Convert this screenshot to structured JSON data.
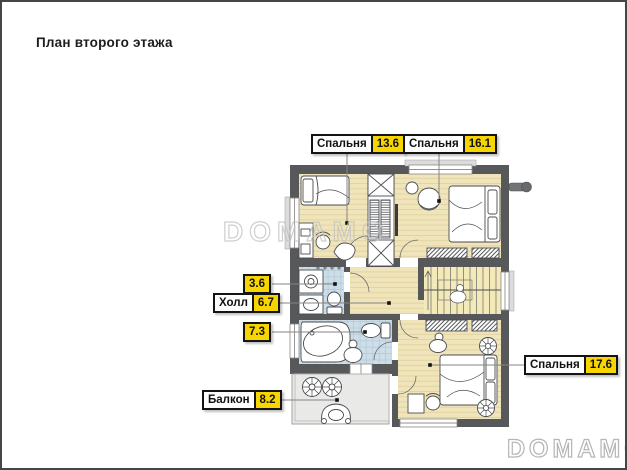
{
  "page": {
    "title": "План второго этажа"
  },
  "watermarks": {
    "center": "DOMAMO",
    "corner": "DOMAMO"
  },
  "rooms": [
    {
      "id": "bedroom-1",
      "name": "Спальня",
      "area": "13.6"
    },
    {
      "id": "bedroom-2",
      "name": "Спальня",
      "area": "16.1"
    },
    {
      "id": "wc",
      "name": "",
      "area": "3.6"
    },
    {
      "id": "hall",
      "name": "Холл",
      "area": "6.7"
    },
    {
      "id": "bathroom",
      "name": "",
      "area": "7.3"
    },
    {
      "id": "balcony",
      "name": "Балкон",
      "area": "8.2"
    },
    {
      "id": "bedroom-3",
      "name": "Спальня",
      "area": "17.6"
    }
  ],
  "palette": {
    "wall": "#57585a",
    "wood_floor": "#efe4ba",
    "wood_line": "#e0d3a2",
    "tile_floor": "#cddee9",
    "tile_line": "#b2c9d7",
    "stairs_floor": "#f4eab9",
    "balcony_floor": "#e9e9e7",
    "label_yellow": "#f6d500",
    "label_border": "#141414",
    "leader_line": "#858585"
  }
}
